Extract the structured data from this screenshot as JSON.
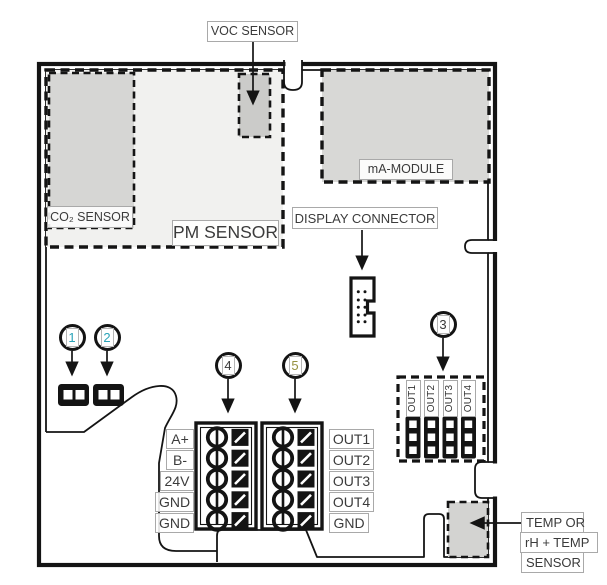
{
  "labels": {
    "voc": "VOC SENSOR",
    "co2": "CO₂ SENSOR",
    "pm": "PM SENSOR",
    "ma_module": "mA-MODULE",
    "display_connector": "DISPLAY CONNECTOR",
    "temp_line1": "TEMP OR",
    "temp_line2": "rH + TEMP",
    "temp_line3": "SENSOR"
  },
  "callouts": [
    {
      "number": "1",
      "color": "#2aa3b8"
    },
    {
      "number": "2",
      "color": "#2aa3b8"
    },
    {
      "number": "3",
      "color": "#3a3a3a"
    },
    {
      "number": "4",
      "color": "#3a3a3a"
    },
    {
      "number": "5",
      "color": "#96913f"
    }
  ],
  "terminal_left": [
    "A+",
    "B-",
    "24V",
    "GND",
    "GND"
  ],
  "terminal_right": [
    "OUT1",
    "OUT2",
    "OUT3",
    "OUT4",
    "GND"
  ],
  "jumper_labels": [
    "OUT1",
    "OUT2",
    "OUT3",
    "OUT4"
  ],
  "colors": {
    "line": "#141414",
    "label_border": "#a9a9a9",
    "text": "#3b3b3b",
    "pm_fill": "#f1f1ef",
    "module_fill": "#d8d8d6",
    "small_sensor_fill": "#cbcbc9",
    "temp_fill": "#d3d3d1"
  }
}
